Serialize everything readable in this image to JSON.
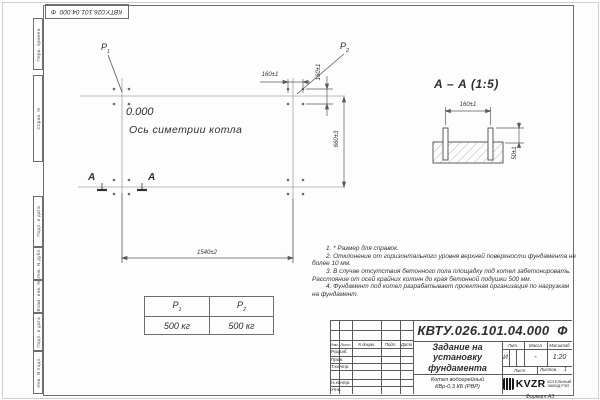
{
  "frame": {
    "top_stamp": "КВТУ.026.101.04.000  Ф",
    "side_labels": [
      "Перв. примен.",
      "Справ. N",
      "Подп. и дата",
      "Инв. N дубл.",
      "Взам. инв. N",
      "Подп. и дата",
      "Инв. N подл."
    ],
    "format_label": "Формат А3"
  },
  "plan": {
    "elevation": "0.000",
    "axis_label": "Ось симетрии котла",
    "p1": {
      "base": "P",
      "sub": "1"
    },
    "p2": {
      "base": "P",
      "sub": "2"
    },
    "section_letter_left": "А",
    "section_letter_right": "А",
    "dim_top_horizontal": "160±1",
    "dim_top_vertical": "160±1",
    "dim_right": "660±3",
    "dim_bottom": "1540±2"
  },
  "section": {
    "title": "А – А (1:5)",
    "dim_width": "160±1",
    "dim_height": "50±1"
  },
  "notes": [
    "1. * Размер для справок.",
    "2. Отклонение от горизонтального уровня верхней поверхности фундамента не более 10 мм.",
    "3. В случае отсутствия бетонного пола площадку под котел забетонировать. Расстояние от осей крайних колонн до края бетонной подушки 500 мм.",
    "4. Фундамент под котел разрабатывает проектная организация по нагрузкам на фундамент."
  ],
  "loads_table": {
    "col1": {
      "base": "Р",
      "sub": "1"
    },
    "col2": {
      "base": "Р",
      "sub": "2"
    },
    "val1": "500 кг",
    "val2": "500 кг"
  },
  "title_block": {
    "designation": "КВТУ.026.101.04.000  Ф",
    "doc_name": "Задание на\nустановку\nфундамента",
    "product": "Котел водогрейный\nКВр-0,3 КБ  (РВР)",
    "header_cols": [
      "Изм.",
      "Лист",
      "N докум.",
      "Подп.",
      "Дата"
    ],
    "sign_rows": [
      "Разраб.",
      "Пров.",
      "Т.контр.",
      "Н.контр.",
      "Утв."
    ],
    "lit_label": "Лит.",
    "mass_label": "Масса",
    "scale_label": "Масштаб",
    "lit_value": "И",
    "mass_value": "-",
    "scale_value": "1:20",
    "sheet_label": "Лист",
    "sheets_label": "Листов",
    "sheets_value": "1",
    "logo": {
      "text": "KVZR",
      "caption": "КОТЕЛЬНЫЙ\nЗАВОД РЭП"
    }
  }
}
